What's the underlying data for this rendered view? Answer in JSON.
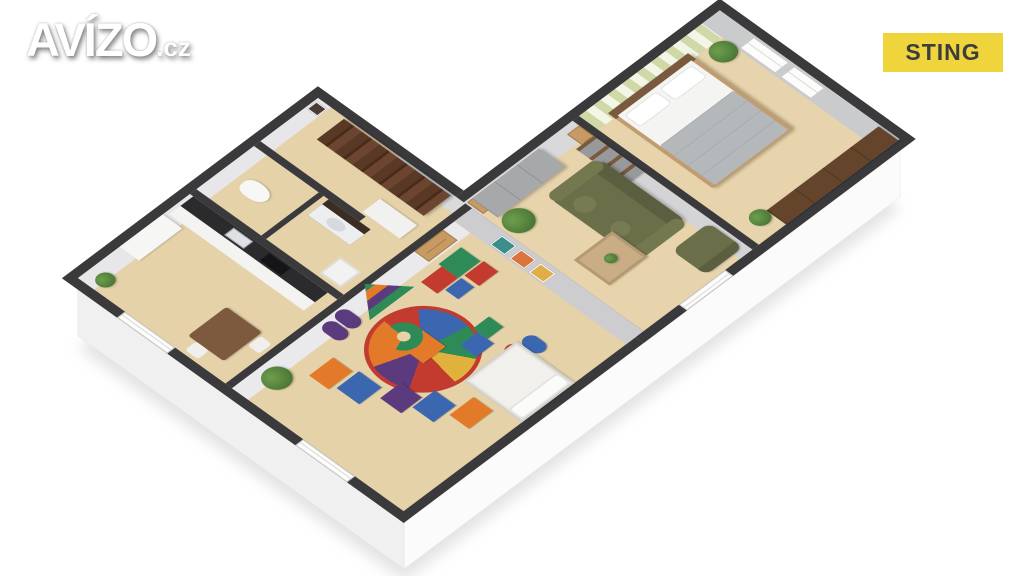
{
  "overlay": {
    "logo": {
      "main": "AVÍZO",
      "suffix": ".cz"
    },
    "badge": {
      "label": "STING"
    }
  },
  "colors": {
    "badge_bg": "#efd53b",
    "badge_text": "#3d3d3d",
    "wall_top": "#3a3a3d",
    "exterior_face": "#f5f5f6",
    "floor_tan": "#e5d2a9",
    "sofa_olive": "#6a6e49",
    "bookshelf_wood": "#53321f",
    "door_wood": "#c79a63",
    "wallpaper_stripe": "#cfd8a6"
  },
  "floorplan": {
    "view": "3d-isometric-cutaway",
    "rooms": [
      {
        "name": "kitchen",
        "furniture": [
          "counter with dark top, sink and stove",
          "white cabinet",
          "dining table",
          "two white chairs",
          "plant"
        ],
        "windows": 1
      },
      {
        "name": "wc",
        "furniture": [
          "toilet"
        ],
        "windows": 0
      },
      {
        "name": "bathroom",
        "furniture": [
          "vanity with basin",
          "washing machine"
        ],
        "windows": 0
      },
      {
        "name": "hallway",
        "furniture": [
          "tall dark-wood bookshelf",
          "white closet",
          "framed pictures"
        ],
        "windows": 0
      },
      {
        "name": "children-room",
        "furniture": [
          "single white bed",
          "round multicolor play rug",
          "foam play blocks",
          "plant",
          "three posters"
        ],
        "windows": 1
      },
      {
        "name": "living-room",
        "furniture": [
          "olive sofa with round pillows",
          "light wood coffee table",
          "olive armchair",
          "gray wardrobe",
          "gray tv shelf",
          "potted tree",
          "picture"
        ],
        "windows": 1
      },
      {
        "name": "bedroom",
        "furniture": [
          "double bed with white pillows and gray blanket",
          "wood headboard",
          "two plants",
          "long dark-wood sideboard"
        ],
        "windows": 2,
        "wallpaper": "green-white vertical stripes"
      }
    ]
  }
}
